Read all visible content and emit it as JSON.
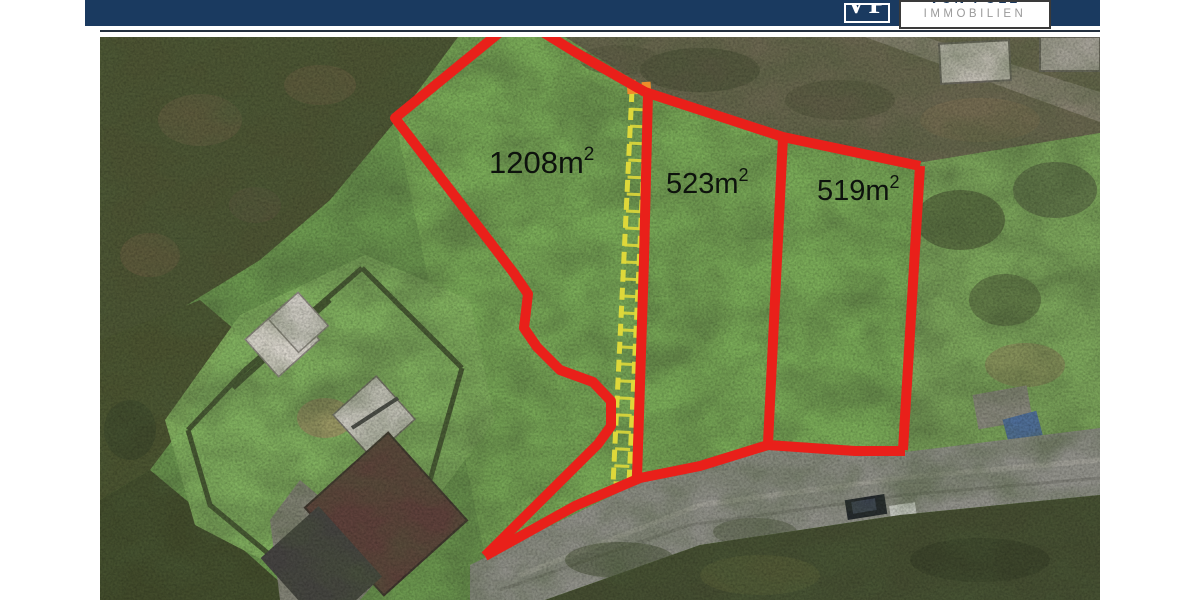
{
  "header": {
    "brand": {
      "monogram": "VP",
      "word_top_partial": "VON POLL",
      "word_bottom": "IMMOBILIEN"
    },
    "bar_color": "#1a3a60"
  },
  "annotation": {
    "outline_color": "#e9201a",
    "access_path_color": "#ded83a",
    "label_color": "#0d120d",
    "plots": [
      {
        "name": "plot-1",
        "label_base": "1208m",
        "label_sup": "2"
      },
      {
        "name": "plot-2",
        "label_base": "523m",
        "label_sup": "2"
      },
      {
        "name": "plot-3",
        "label_base": "519m",
        "label_sup": "2"
      }
    ]
  }
}
